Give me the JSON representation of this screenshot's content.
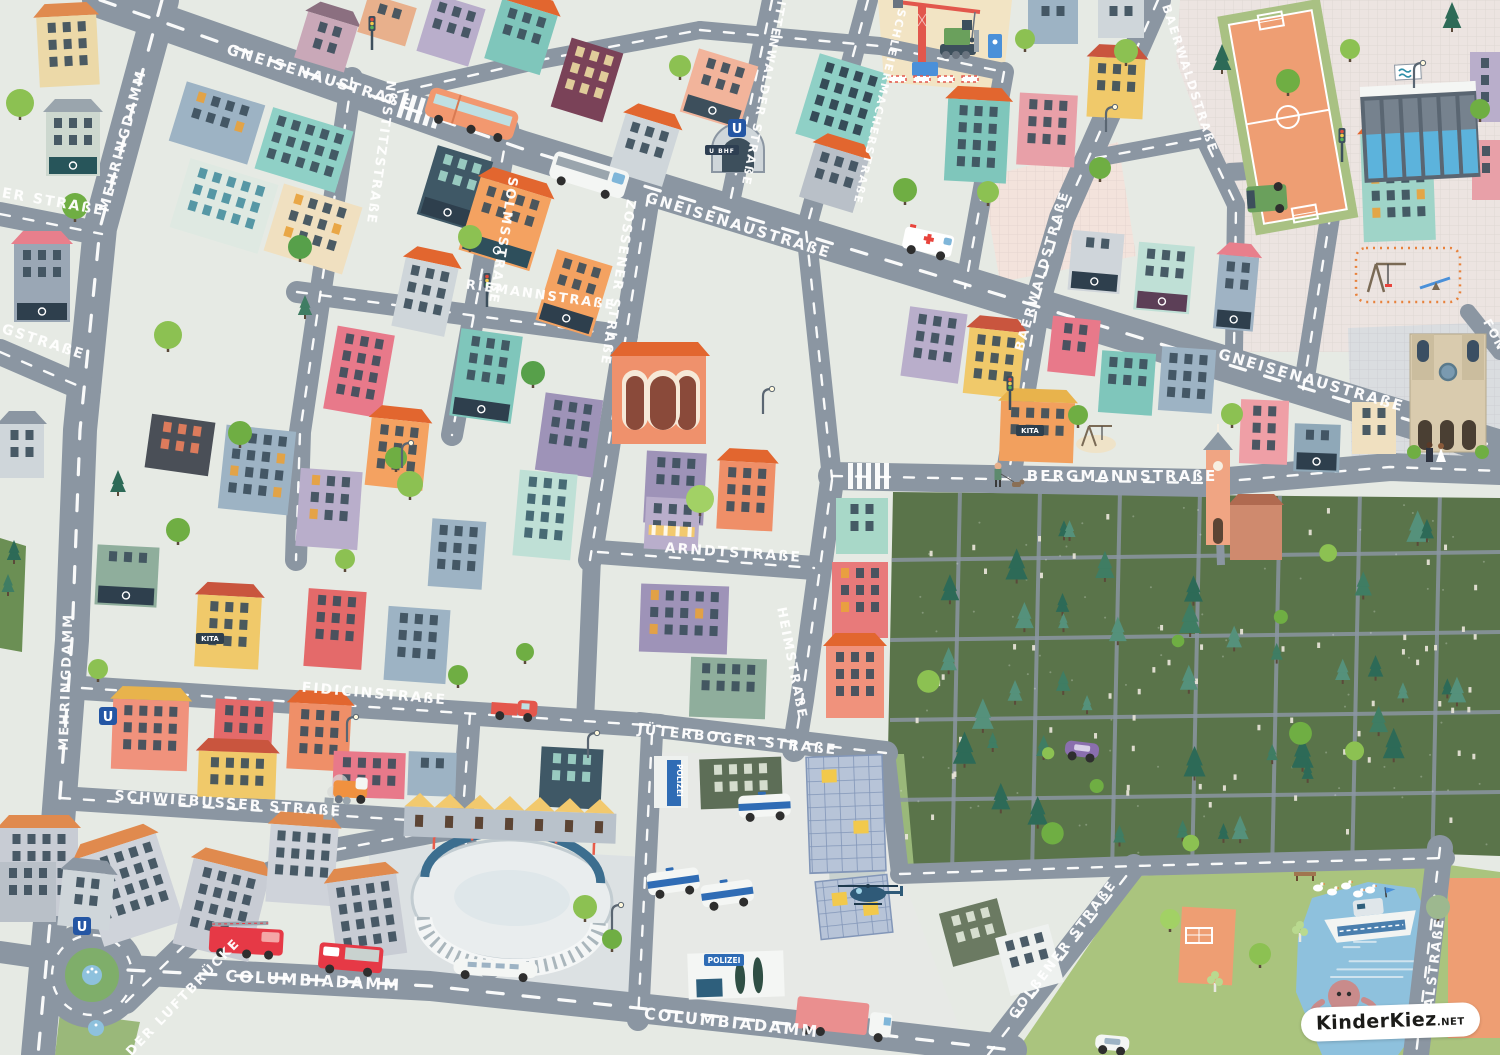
{
  "map": {
    "type": "illustrated-children-city-map",
    "background": "#e6eae4",
    "road_color": "#8b96a2",
    "park_color": "#5a744a",
    "grass_color": "#aac47e",
    "water_color": "#8ec1dd",
    "pitch_color": "#ee9e73",
    "attribution": {
      "text": "KinderKiez",
      "suffix": ".NET"
    },
    "signs": {
      "police": "POLIZEI",
      "kita": "KITA",
      "ubahn": "U",
      "ubahn_station": "U BHF"
    },
    "sign_positions": {
      "kita": [
        [
          210,
          641
        ],
        [
          1030,
          433
        ]
      ],
      "police_banner": [
        [
          674,
          760
        ]
      ],
      "police_sign": [
        [
          706,
          963
        ]
      ],
      "ubahn": [
        [
          737,
          128
        ],
        [
          108,
          716
        ],
        [
          82,
          926
        ]
      ],
      "ubahn_station": [
        [
          722,
          152
        ]
      ]
    },
    "streets": [
      {
        "name": "gneisenaustrasse",
        "label": "GNEISENAUSTRAßE",
        "width": 36,
        "dashed": true,
        "path": [
          [
            100,
            0
          ],
          [
            520,
            148
          ],
          [
            1010,
            298
          ],
          [
            1500,
            448
          ]
        ],
        "labels": [
          {
            "x": 318,
            "y": 82,
            "a": 17,
            "s": 15
          },
          {
            "x": 737,
            "y": 230,
            "a": 17,
            "s": 15
          },
          {
            "x": 1310,
            "y": 385,
            "a": 16,
            "s": 15
          }
        ]
      },
      {
        "name": "mehringdamm",
        "label": "MEHRINGDAMM",
        "width": 34,
        "dashed": true,
        "path": [
          [
            162,
            0
          ],
          [
            100,
            228
          ],
          [
            80,
            430
          ],
          [
            72,
            640
          ],
          [
            52,
            900
          ],
          [
            38,
            1055
          ]
        ],
        "labels": [
          {
            "x": 127,
            "y": 142,
            "a": -75,
            "s": 14
          },
          {
            "x": 70,
            "y": 682,
            "a": -88,
            "s": 13
          }
        ]
      },
      {
        "name": "ger-strasse-partial",
        "label": "GER STRAßE",
        "width": 24,
        "dashed": true,
        "path": [
          [
            0,
            214
          ],
          [
            102,
            234
          ]
        ],
        "labels": [
          {
            "x": 46,
            "y": 205,
            "a": 10,
            "s": 14
          }
        ]
      },
      {
        "name": "rgstrasse-partial",
        "label": "RGSTRAßE",
        "width": 26,
        "dashed": true,
        "path": [
          [
            0,
            352
          ],
          [
            88,
            390
          ]
        ],
        "labels": [
          {
            "x": 36,
            "y": 344,
            "a": 18,
            "s": 14
          }
        ]
      },
      {
        "name": "nostitzstrasse",
        "label": "NOSTITZSTRAßE",
        "width": 22,
        "dashed": true,
        "path": [
          [
            352,
            78
          ],
          [
            300,
            432
          ],
          [
            296,
            560
          ]
        ],
        "labels": [
          {
            "x": 377,
            "y": 152,
            "a": 98,
            "s": 13
          }
        ]
      },
      {
        "name": "solmsstrasse",
        "label": "SOLMSSTRAßE",
        "width": 22,
        "dashed": true,
        "path": [
          [
            508,
            128
          ],
          [
            452,
            435
          ]
        ],
        "labels": [
          {
            "x": 499,
            "y": 240,
            "a": 99,
            "s": 13
          }
        ]
      },
      {
        "name": "zossener-strasse",
        "label": "ZOSSENER STRAßE",
        "width": 24,
        "dashed": true,
        "path": [
          [
            652,
            172
          ],
          [
            590,
            560
          ]
        ],
        "labels": [
          {
            "x": 614,
            "y": 282,
            "a": 99,
            "s": 13
          }
        ]
      },
      {
        "name": "mittenwalder-strasse",
        "label": "MITTENWALDER STRAßE",
        "width": 20,
        "dashed": true,
        "path": [
          [
            772,
            0
          ],
          [
            728,
            212
          ]
        ],
        "labels": [
          {
            "x": 761,
            "y": 86,
            "a": 101,
            "s": 12
          }
        ]
      },
      {
        "name": "schleiermacherstrasse",
        "label": "SCHLEIERMACHERSTRAßE",
        "width": 20,
        "dashed": true,
        "path": [
          [
            868,
            0
          ],
          [
            806,
            230
          ],
          [
            832,
            478
          ]
        ],
        "labels": [
          {
            "x": 876,
            "y": 106,
            "a": 103,
            "s": 11
          }
        ]
      },
      {
        "name": "riemannstrasse",
        "label": "RIEMANNSTRAßE",
        "width": 22,
        "dashed": true,
        "path": [
          [
            297,
            292
          ],
          [
            627,
            336
          ]
        ],
        "labels": [
          {
            "x": 540,
            "y": 299,
            "a": 8,
            "s": 13
          }
        ]
      },
      {
        "name": "baerwaldstrasse",
        "label": "BAERWALDSTRAßE",
        "width": 26,
        "dashed": true,
        "path": [
          [
            1158,
            0
          ],
          [
            1062,
            218
          ],
          [
            1038,
            300
          ],
          [
            1008,
            478
          ]
        ],
        "labels": [
          {
            "x": 1046,
            "y": 272,
            "a": -74,
            "s": 13
          },
          {
            "x": 1162,
            "y": 6,
            "a": 72,
            "s": 12,
            "anchor": "start"
          }
        ]
      },
      {
        "name": "bergmannstrasse",
        "label": "BERGMANNSTRAßE",
        "width": 28,
        "dashed": true,
        "path": [
          [
            832,
            476
          ],
          [
            1205,
            483
          ],
          [
            1390,
            467
          ],
          [
            1500,
            471
          ]
        ],
        "labels": [
          {
            "x": 1122,
            "y": 481,
            "a": 0,
            "s": 15
          }
        ]
      },
      {
        "name": "arndtstrasse",
        "label": "ARNDTSTRAßE",
        "width": 24,
        "dashed": true,
        "path": [
          [
            598,
            552
          ],
          [
            814,
            568
          ]
        ],
        "labels": [
          {
            "x": 733,
            "y": 557,
            "a": 4,
            "s": 14
          }
        ]
      },
      {
        "name": "heimstrasse",
        "label": "HEIMSTRAßE",
        "width": 24,
        "dashed": true,
        "path": [
          [
            832,
            480
          ],
          [
            802,
            700
          ],
          [
            794,
            750
          ]
        ],
        "labels": [
          {
            "x": 788,
            "y": 664,
            "a": 79,
            "s": 13
          }
        ]
      },
      {
        "name": "fidicinstrasse",
        "label": "FIDICINSTRAßE",
        "width": 24,
        "dashed": true,
        "path": [
          [
            82,
            688
          ],
          [
            660,
            726
          ]
        ],
        "labels": [
          {
            "x": 374,
            "y": 698,
            "a": 5,
            "s": 14
          }
        ]
      },
      {
        "name": "jueterboger-strasse",
        "label": "JÜTERBOGER STRAßE",
        "width": 24,
        "dashed": true,
        "path": [
          [
            640,
            724
          ],
          [
            886,
            753
          ]
        ],
        "labels": [
          {
            "x": 737,
            "y": 744,
            "a": 6,
            "s": 14
          }
        ]
      },
      {
        "name": "schwiebusser-strasse",
        "label": "SCHWIEBUSSER STRAßE",
        "width": 24,
        "dashed": true,
        "path": [
          [
            60,
            798
          ],
          [
            472,
            824
          ]
        ],
        "labels": [
          {
            "x": 228,
            "y": 808,
            "a": 4,
            "s": 14
          }
        ]
      },
      {
        "name": "columbiadamm",
        "label": "COLUMBIADAMM",
        "width": 30,
        "dashed": true,
        "path": [
          [
            128,
            970
          ],
          [
            430,
            986
          ],
          [
            770,
            1022
          ],
          [
            1012,
            1050
          ]
        ],
        "labels": [
          {
            "x": 313,
            "y": 986,
            "a": 3,
            "s": 16
          },
          {
            "x": 731,
            "y": 1028,
            "a": 6,
            "s": 16
          }
        ]
      },
      {
        "name": "golssener-strasse",
        "label": "GOLßENER STRAßE",
        "width": 24,
        "dashed": true,
        "path": [
          [
            988,
            1055
          ],
          [
            1134,
            866
          ]
        ],
        "labels": [
          {
            "x": 1066,
            "y": 952,
            "a": -53,
            "s": 13
          }
        ]
      },
      {
        "name": "platz-der-luftbruecke-partial",
        "label": "DER LUFTBRÜCKE",
        "width": 24,
        "dashed": true,
        "path": [
          [
            126,
            1002
          ],
          [
            252,
            880
          ],
          [
            334,
            850
          ],
          [
            472,
            824
          ]
        ],
        "labels": [
          {
            "x": 186,
            "y": 1000,
            "a": -46,
            "s": 13
          }
        ]
      },
      {
        "name": "thalstrasse-partial",
        "label": "THALSTRAßE",
        "width": 26,
        "dashed": true,
        "path": [
          [
            1440,
            848
          ],
          [
            1416,
            1055
          ]
        ],
        "labels": [
          {
            "x": 1437,
            "y": 975,
            "a": -83,
            "s": 13
          }
        ]
      },
      {
        "name": "fon-partial",
        "label": "FON",
        "width": 16,
        "dashed": false,
        "path": [
          [
            1468,
            312
          ],
          [
            1500,
            352
          ]
        ],
        "labels": [
          {
            "x": 1491,
            "y": 337,
            "a": 62,
            "s": 12
          }
        ]
      },
      {
        "name": "park-south-road",
        "label": "",
        "width": 20,
        "dashed": true,
        "path": [
          [
            900,
            874
          ],
          [
            1134,
            866
          ],
          [
            1445,
            858
          ]
        ]
      },
      {
        "name": "park-west-road",
        "label": "",
        "width": 18,
        "dashed": false,
        "path": [
          [
            886,
            752
          ],
          [
            900,
            874
          ]
        ]
      },
      {
        "name": "stadium-west-road",
        "label": "",
        "width": 22,
        "dashed": true,
        "path": [
          [
            470,
            714
          ],
          [
            462,
            824
          ],
          [
            490,
            968
          ]
        ]
      },
      {
        "name": "police-west-road",
        "label": "",
        "width": 22,
        "dashed": true,
        "path": [
          [
            652,
            734
          ],
          [
            638,
            1020
          ]
        ]
      },
      {
        "name": "north-road-1",
        "label": "",
        "width": 18,
        "dashed": true,
        "path": [
          [
            398,
            92
          ],
          [
            540,
            60
          ],
          [
            700,
            30
          ]
        ]
      },
      {
        "name": "north-road-2",
        "label": "",
        "width": 18,
        "dashed": true,
        "path": [
          [
            700,
            30
          ],
          [
            880,
            46
          ],
          [
            1004,
            72
          ]
        ]
      },
      {
        "name": "construction-road",
        "label": "",
        "width": 20,
        "dashed": true,
        "path": [
          [
            1004,
            72
          ],
          [
            965,
            288
          ]
        ]
      },
      {
        "name": "pool-west-road",
        "label": "",
        "width": 18,
        "dashed": true,
        "path": [
          [
            1096,
            158
          ],
          [
            1204,
            138
          ],
          [
            1236,
            205
          ],
          [
            1234,
            352
          ]
        ]
      },
      {
        "name": "pool-south-road",
        "label": "",
        "width": 18,
        "dashed": false,
        "path": [
          [
            1230,
            172
          ],
          [
            1338,
            166
          ]
        ]
      },
      {
        "name": "church-west-road",
        "label": "",
        "width": 20,
        "dashed": true,
        "path": [
          [
            1338,
            166
          ],
          [
            1303,
            390
          ]
        ]
      },
      {
        "name": "zossener-south-road",
        "label": "",
        "width": 18,
        "dashed": false,
        "path": [
          [
            592,
            558
          ],
          [
            585,
            722
          ]
        ]
      },
      {
        "name": "columbiadamm-west-stub",
        "label": "",
        "width": 22,
        "dashed": false,
        "path": [
          [
            0,
            952
          ],
          [
            56,
            960
          ]
        ]
      }
    ],
    "landmarks": [
      {
        "name": "gothic-church",
        "x": 1408,
        "y": 332
      },
      {
        "name": "market-hall",
        "x": 612,
        "y": 352
      },
      {
        "name": "cemetery-chapel",
        "x": 1204,
        "y": 448
      },
      {
        "name": "indoor-pool",
        "x": 1362,
        "y": 82
      },
      {
        "name": "sports-field",
        "x": 1238,
        "y": 8
      },
      {
        "name": "athletics-stadium",
        "x": 512,
        "y": 900
      },
      {
        "name": "playground",
        "x": 1358,
        "y": 250
      },
      {
        "name": "small-playground",
        "x": 1082,
        "y": 432
      },
      {
        "name": "construction-site",
        "x": 886,
        "y": 0
      },
      {
        "name": "u-bahn-entrance",
        "x": 712,
        "y": 120
      },
      {
        "name": "roundabout-fountain",
        "x": 92,
        "y": 975
      },
      {
        "name": "fountain",
        "x": 96,
        "y": 1028
      },
      {
        "name": "octopus",
        "x": 1344,
        "y": 996
      },
      {
        "name": "geese",
        "x": 1318,
        "y": 888
      },
      {
        "name": "police-helipad",
        "x": 830,
        "y": 862
      },
      {
        "name": "police-hq",
        "x": 688,
        "y": 952
      },
      {
        "name": "police-banner-building",
        "x": 655,
        "y": 756
      },
      {
        "name": "solar-hall",
        "x": 808,
        "y": 756
      },
      {
        "name": "solar-hall",
        "x": 818,
        "y": 878
      },
      {
        "name": "yellow-gable-row",
        "x": 404,
        "y": 810
      },
      {
        "name": "soccer-goal",
        "x": 1186,
        "y": 928
      },
      {
        "name": "wedding-couple",
        "x": 1436,
        "y": 446
      },
      {
        "name": "dog-walker",
        "x": 998,
        "y": 478
      },
      {
        "name": "bench",
        "x": 1294,
        "y": 872
      }
    ],
    "vehicles": [
      {
        "name": "bus",
        "x": 432,
        "y": 86,
        "a": 17
      },
      {
        "name": "camper-van",
        "x": 556,
        "y": 150,
        "a": 17
      },
      {
        "name": "ambulance",
        "x": 906,
        "y": 226,
        "a": 12
      },
      {
        "name": "fire-engine-ladder",
        "x": 210,
        "y": 926,
        "a": 3
      },
      {
        "name": "fire-engine",
        "x": 320,
        "y": 942,
        "a": 5
      },
      {
        "name": "cargo-truck",
        "x": 798,
        "y": 996,
        "a": 6
      },
      {
        "name": "street-sweeper",
        "x": 334,
        "y": 776,
        "a": 3
      },
      {
        "name": "pickup-truck",
        "x": 492,
        "y": 698,
        "a": 4
      },
      {
        "name": "limousine",
        "x": 454,
        "y": 958,
        "a": 3
      },
      {
        "name": "police-van",
        "x": 738,
        "y": 796,
        "a": -3
      },
      {
        "name": "police-van",
        "x": 646,
        "y": 874,
        "a": -8
      },
      {
        "name": "police-van",
        "x": 700,
        "y": 886,
        "a": -8
      },
      {
        "name": "delivery-truck",
        "x": 1286,
        "y": 184,
        "a": 86
      },
      {
        "name": "car-purple",
        "x": 1066,
        "y": 740,
        "a": 7
      },
      {
        "name": "car-white",
        "x": 1096,
        "y": 1034,
        "a": 5
      },
      {
        "name": "helicopter",
        "x": 848,
        "y": 884,
        "a": 0
      },
      {
        "name": "boat",
        "x": 1322,
        "y": 898,
        "a": -6
      }
    ]
  }
}
